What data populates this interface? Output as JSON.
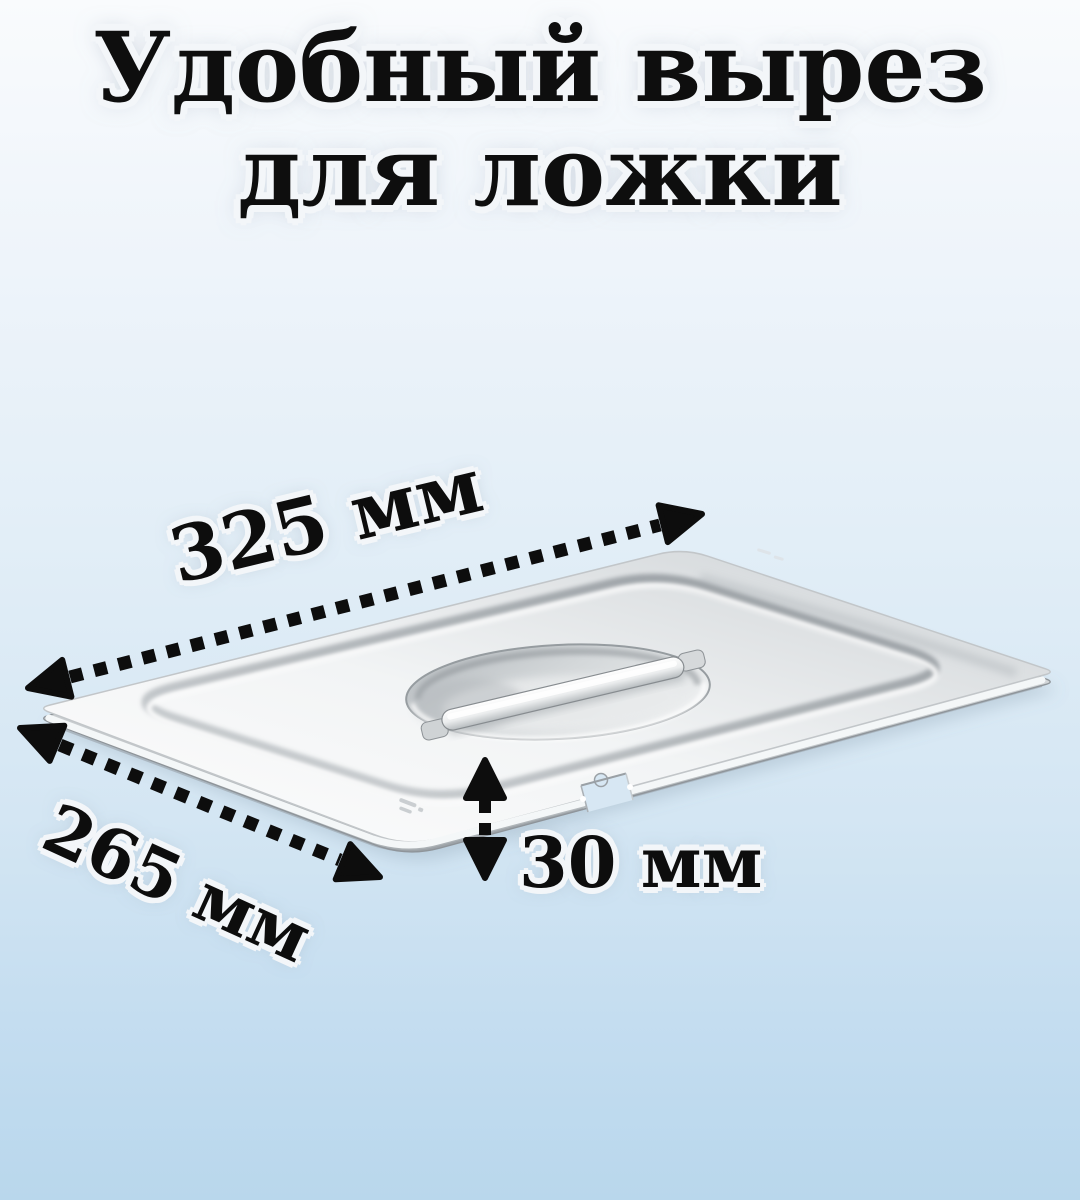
{
  "title": {
    "line1": "Удобный вырез",
    "line2": "для ложки"
  },
  "dimensions": [
    {
      "id": "length",
      "label": "325 мм"
    },
    {
      "id": "width",
      "label": "265 мм"
    },
    {
      "id": "cutout",
      "label": "30 мм"
    }
  ],
  "icons": {
    "dimension_arrow": "double-headed-dotted-arrow"
  },
  "colors": {
    "bg_top": "#f9fbfd",
    "bg_bottom": "#b9d7ec",
    "text": "#0e0e0e",
    "text_outline": "#f3f6f9",
    "arrow": "#0d0d0d",
    "metal_light": "#fdfdfd",
    "metal_mid": "#dde0e2",
    "metal_dark": "#a9aeb2"
  }
}
